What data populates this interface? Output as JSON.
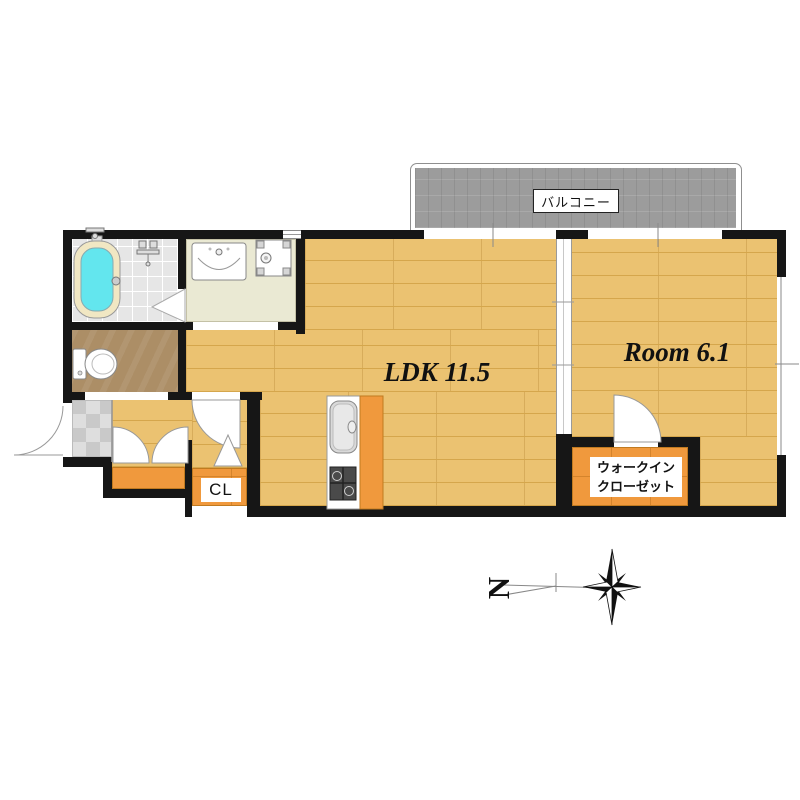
{
  "plan": {
    "balcony_label": "バルコニー",
    "rooms": [
      {
        "key": "ldk",
        "label": "LDK 11.5",
        "floor": "wood"
      },
      {
        "key": "western-room",
        "label": "Room 6.1",
        "floor": "wood"
      },
      {
        "key": "walk-in-closet",
        "label_line1": "ウォークイン",
        "label_line2": "クローゼット",
        "floor": "orange"
      },
      {
        "key": "closet",
        "label": "CL",
        "floor": "orange"
      }
    ],
    "icons": [
      "bathtub-icon",
      "bath-faucet-icon",
      "shower-mixer-icon",
      "washbasin-icon",
      "washing-machine-pan-icon",
      "toilet-icon",
      "kitchen-sink-icon",
      "gas-stove-icon",
      "door-arc-icon",
      "double-closet-doors-icon",
      "folding-door-icon",
      "compass-rose-icon"
    ]
  },
  "compass": {
    "north_label": "N"
  },
  "palette": {
    "wall": "#161616",
    "wood_floor": "#EBC271",
    "wood_line": "#D5A64C",
    "closet_orange": "#F0993D",
    "closet_line": "#C07A20",
    "toilet_floor": "#AC8E66",
    "washroom_floor": "#EAE9D3",
    "bathroom_tile": "#E6E6E6",
    "entrance_tile": "#DEDEDE",
    "balcony_gray": "#9C9C9C",
    "bathtub_cyan": "#63E6EE",
    "bathtub_rim": "#F1E7C3",
    "outline_gray": "#8F8F8F",
    "text": "#111111"
  }
}
